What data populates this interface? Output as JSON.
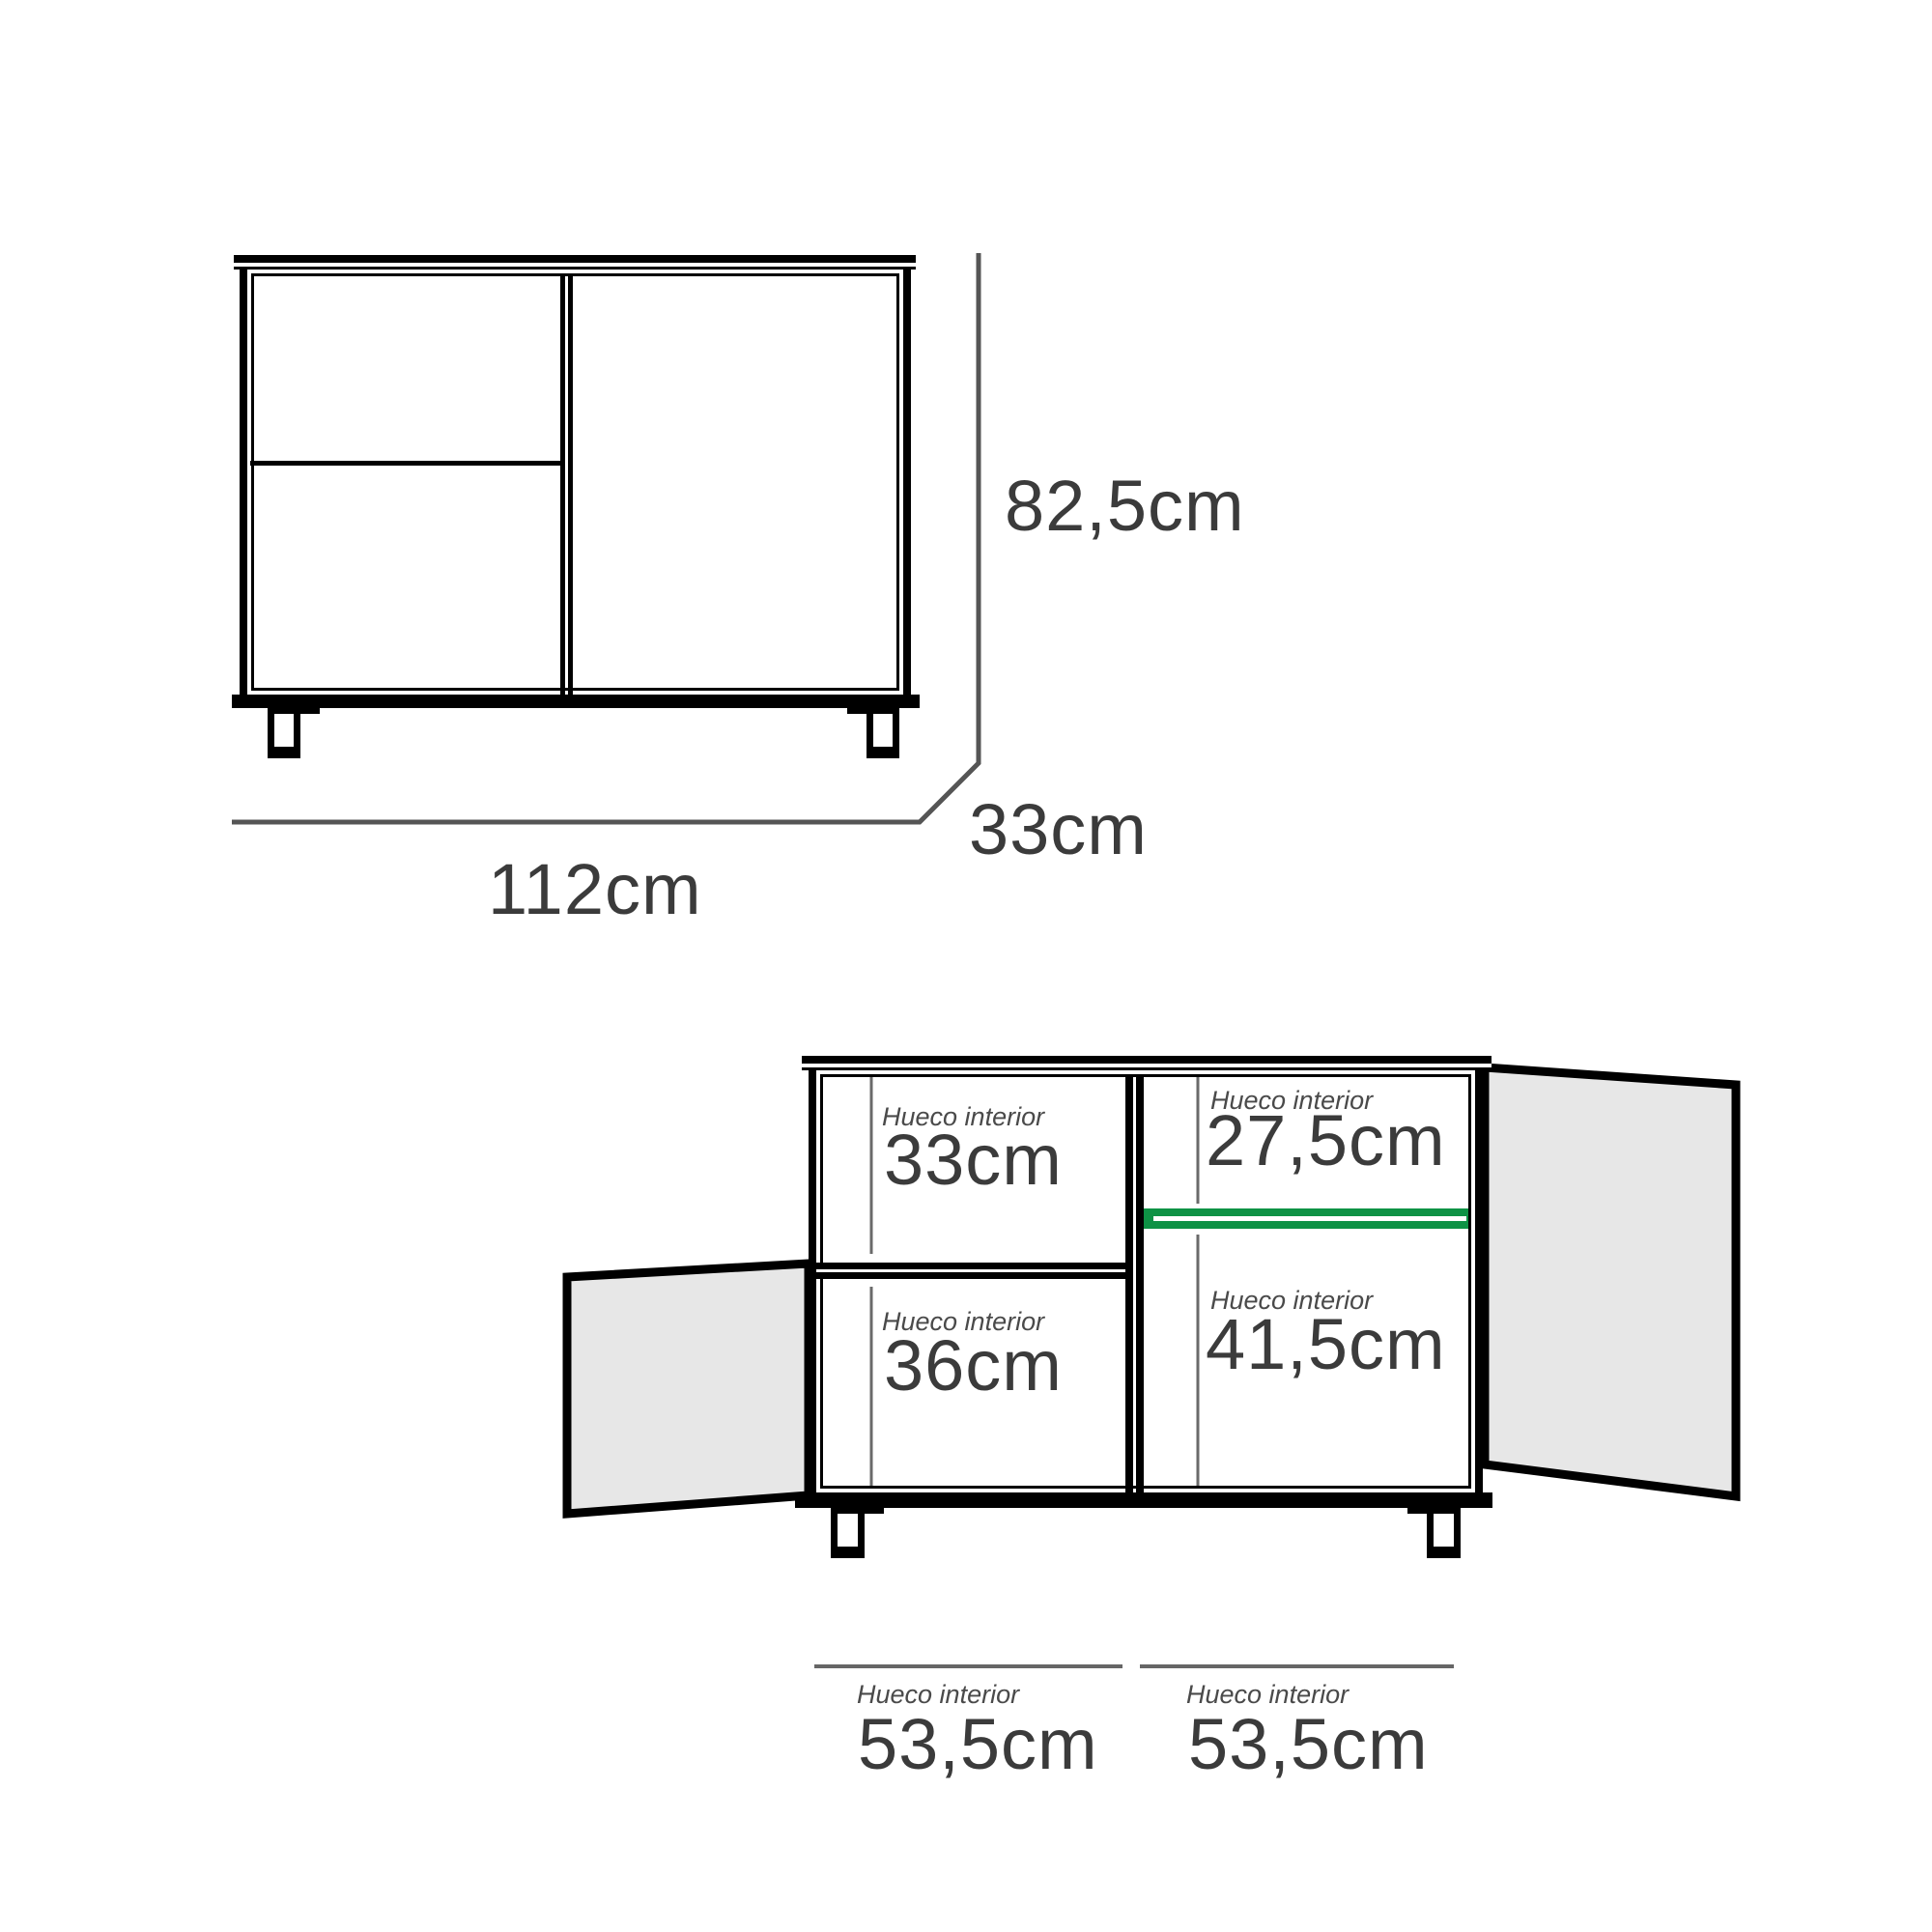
{
  "page": {
    "background": "#ffffff"
  },
  "front_view": {
    "height_label": "82,5cm",
    "width_label": "112cm",
    "depth_label": "33cm"
  },
  "open_view": {
    "compartments": [
      {
        "position": "top-left",
        "caption": "Hueco interior",
        "value": "33cm"
      },
      {
        "position": "top-right",
        "caption": "Hueco interior",
        "value": "27,5cm"
      },
      {
        "position": "bottom-left",
        "caption": "Hueco interior",
        "value": "36cm"
      },
      {
        "position": "bottom-right",
        "caption": "Hueco interior",
        "value": "41,5cm"
      }
    ]
  },
  "bottom_dimensions": [
    {
      "caption": "Hueco interior",
      "value": "53,5cm"
    },
    {
      "caption": "Hueco interior",
      "value": "53,5cm"
    }
  ],
  "colors": {
    "outline": "#000000",
    "dimension_line": "#555555",
    "reference_line": "#6a6a6a",
    "bottom_dimension_line": "#666666",
    "number_text": "#3b3b3b",
    "caption_text": "#4a4a4a",
    "door_fill": "#e7e7e7",
    "shelf_green": "#0e9245"
  }
}
